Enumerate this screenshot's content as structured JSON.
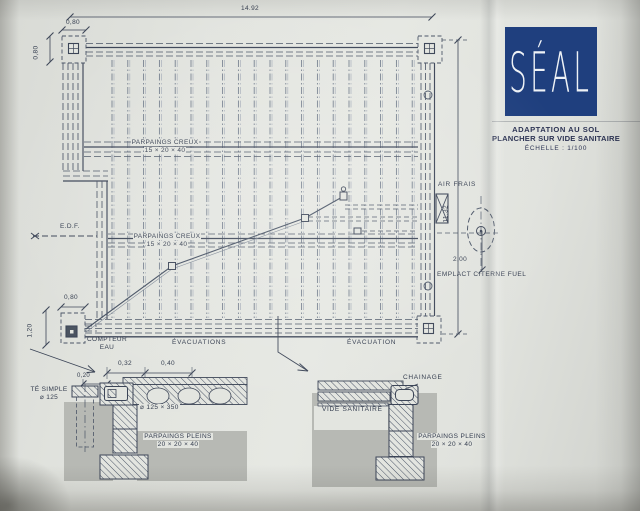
{
  "logo": {
    "text": "SÉAL"
  },
  "title_block": {
    "line1": "ADAPTATION AU SOL",
    "line2": "PLANCHER SUR VIDE SANITAIRE",
    "line3": "ÉCHELLE : 1/100"
  },
  "plan": {
    "dims": {
      "total_width": "14.92",
      "corner_w": "0,80",
      "corner_h": "0,80",
      "total_height": "11,32",
      "tank_offset": "2,00",
      "meter_w": "0,80",
      "meter_h": "1,20"
    },
    "labels": {
      "parpaings_creux_line1": "PARPAINGS CREUX",
      "parpaings_creux_line2": "15 × 20 × 40",
      "edf": "E.D.F.",
      "air_frais": "AIR FRAIS",
      "emplacement_citerne": "EMPLACT CITERNE FUEL",
      "compteur_line1": "COMPTEUR",
      "compteur_line2": "EAU",
      "evacuations": "ÉVACUATIONS",
      "evacuation": "ÉVACUATION"
    }
  },
  "detail_left": {
    "dims": {
      "d1": "0,32",
      "d2": "0,40",
      "d3": "0,20"
    },
    "labels": {
      "te_line1": "TÉ SIMPLE",
      "te_line2": "⌀ 125",
      "slab": "⌀ 125 × 350",
      "parpaings_line1": "PARPAINGS PLEINS",
      "parpaings_line2": "20 × 20 × 40"
    }
  },
  "detail_right": {
    "labels": {
      "chainage": "CHAINAGE",
      "vide_sanitaire": "VIDE SANITAIRE",
      "parpaings_line1": "PARPAINGS PLEINS",
      "parpaings_line2": "20 × 20 × 40"
    }
  },
  "colors": {
    "logo_blue": "#1f3f7e",
    "ink": "#4a5466",
    "ink_dark": "#3c4557",
    "joist": "#6d7888",
    "joist_light": "#a6adb9",
    "paper": "#e3e5e0",
    "ground_grey": "#b7b9b4",
    "title_ink": "#2b3252"
  }
}
